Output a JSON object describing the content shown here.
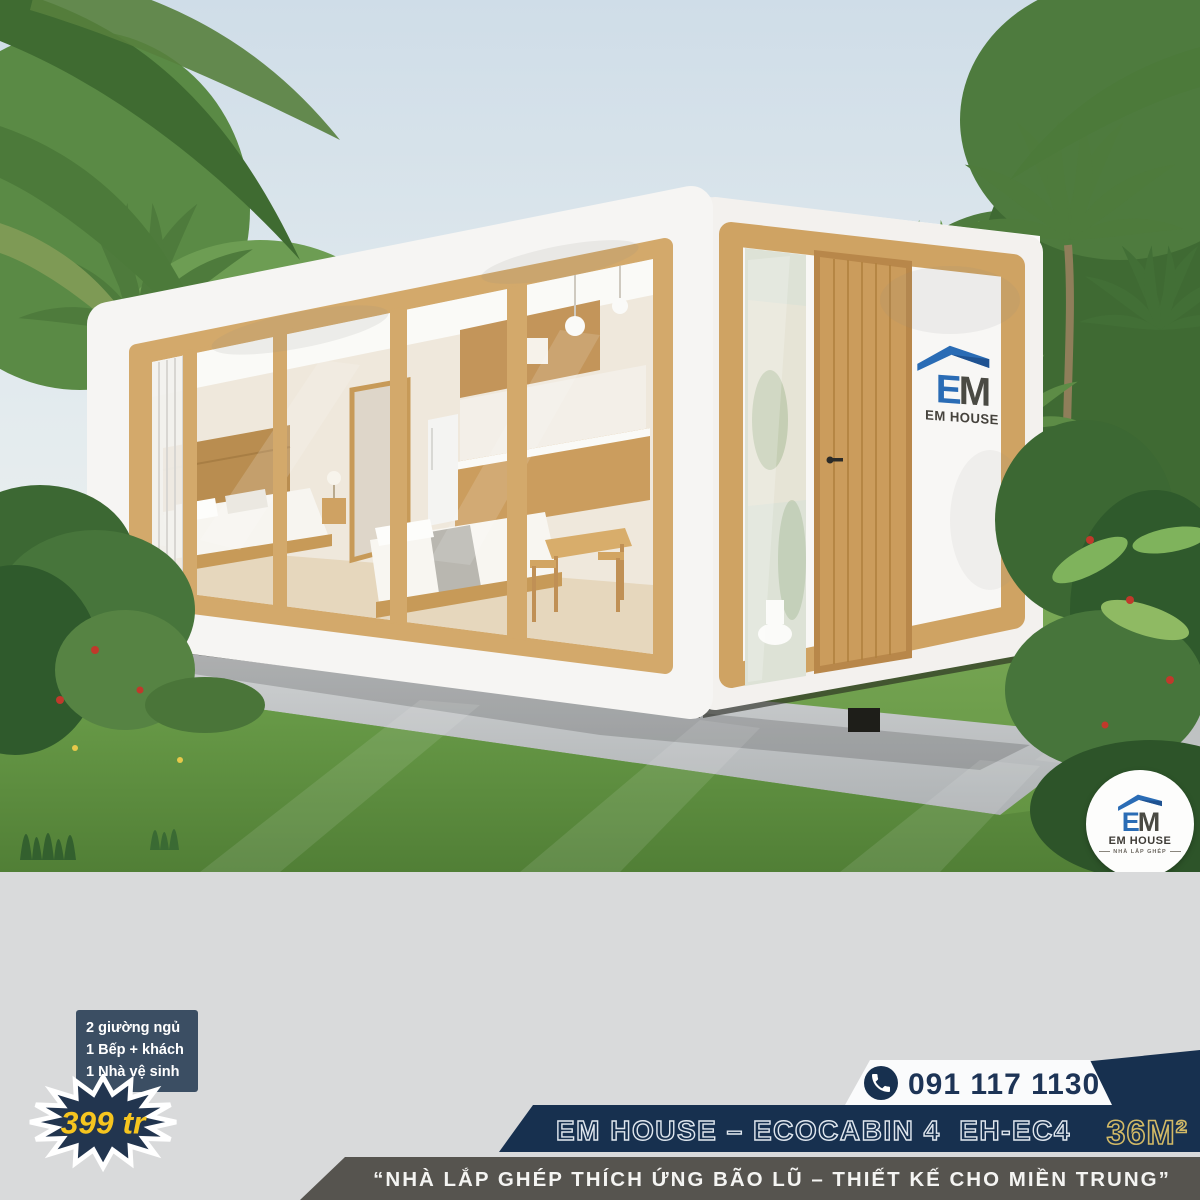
{
  "brand": {
    "e": "E",
    "m": "M",
    "name": "EM HOUSE",
    "tagline": "NHÀ LẮP GHÉP"
  },
  "badge": {
    "features": [
      "2 giường ngủ",
      "1 Bếp + khách",
      "1 Nhà vệ sinh"
    ],
    "price": "399 tr"
  },
  "contact": {
    "phone": "091 117 1130"
  },
  "product": {
    "title": "EM HOUSE – ECOCABIN 4  EH-EC4",
    "area": "36M²"
  },
  "slogan": "“NHÀ LẮP GHÉP THÍCH ỨNG BÃO LŨ – THIẾT KẾ CHO MIỀN TRUNG”",
  "colors": {
    "navy": "#17304f",
    "navy_light": "#3b4e63",
    "yellow": "#f6c51f",
    "gold": "#d2b966",
    "slogan_gray": "#56544f",
    "band_gray": "#d9dadb",
    "wood": "#cfa363",
    "logo_blue": "#2a6cb5"
  }
}
